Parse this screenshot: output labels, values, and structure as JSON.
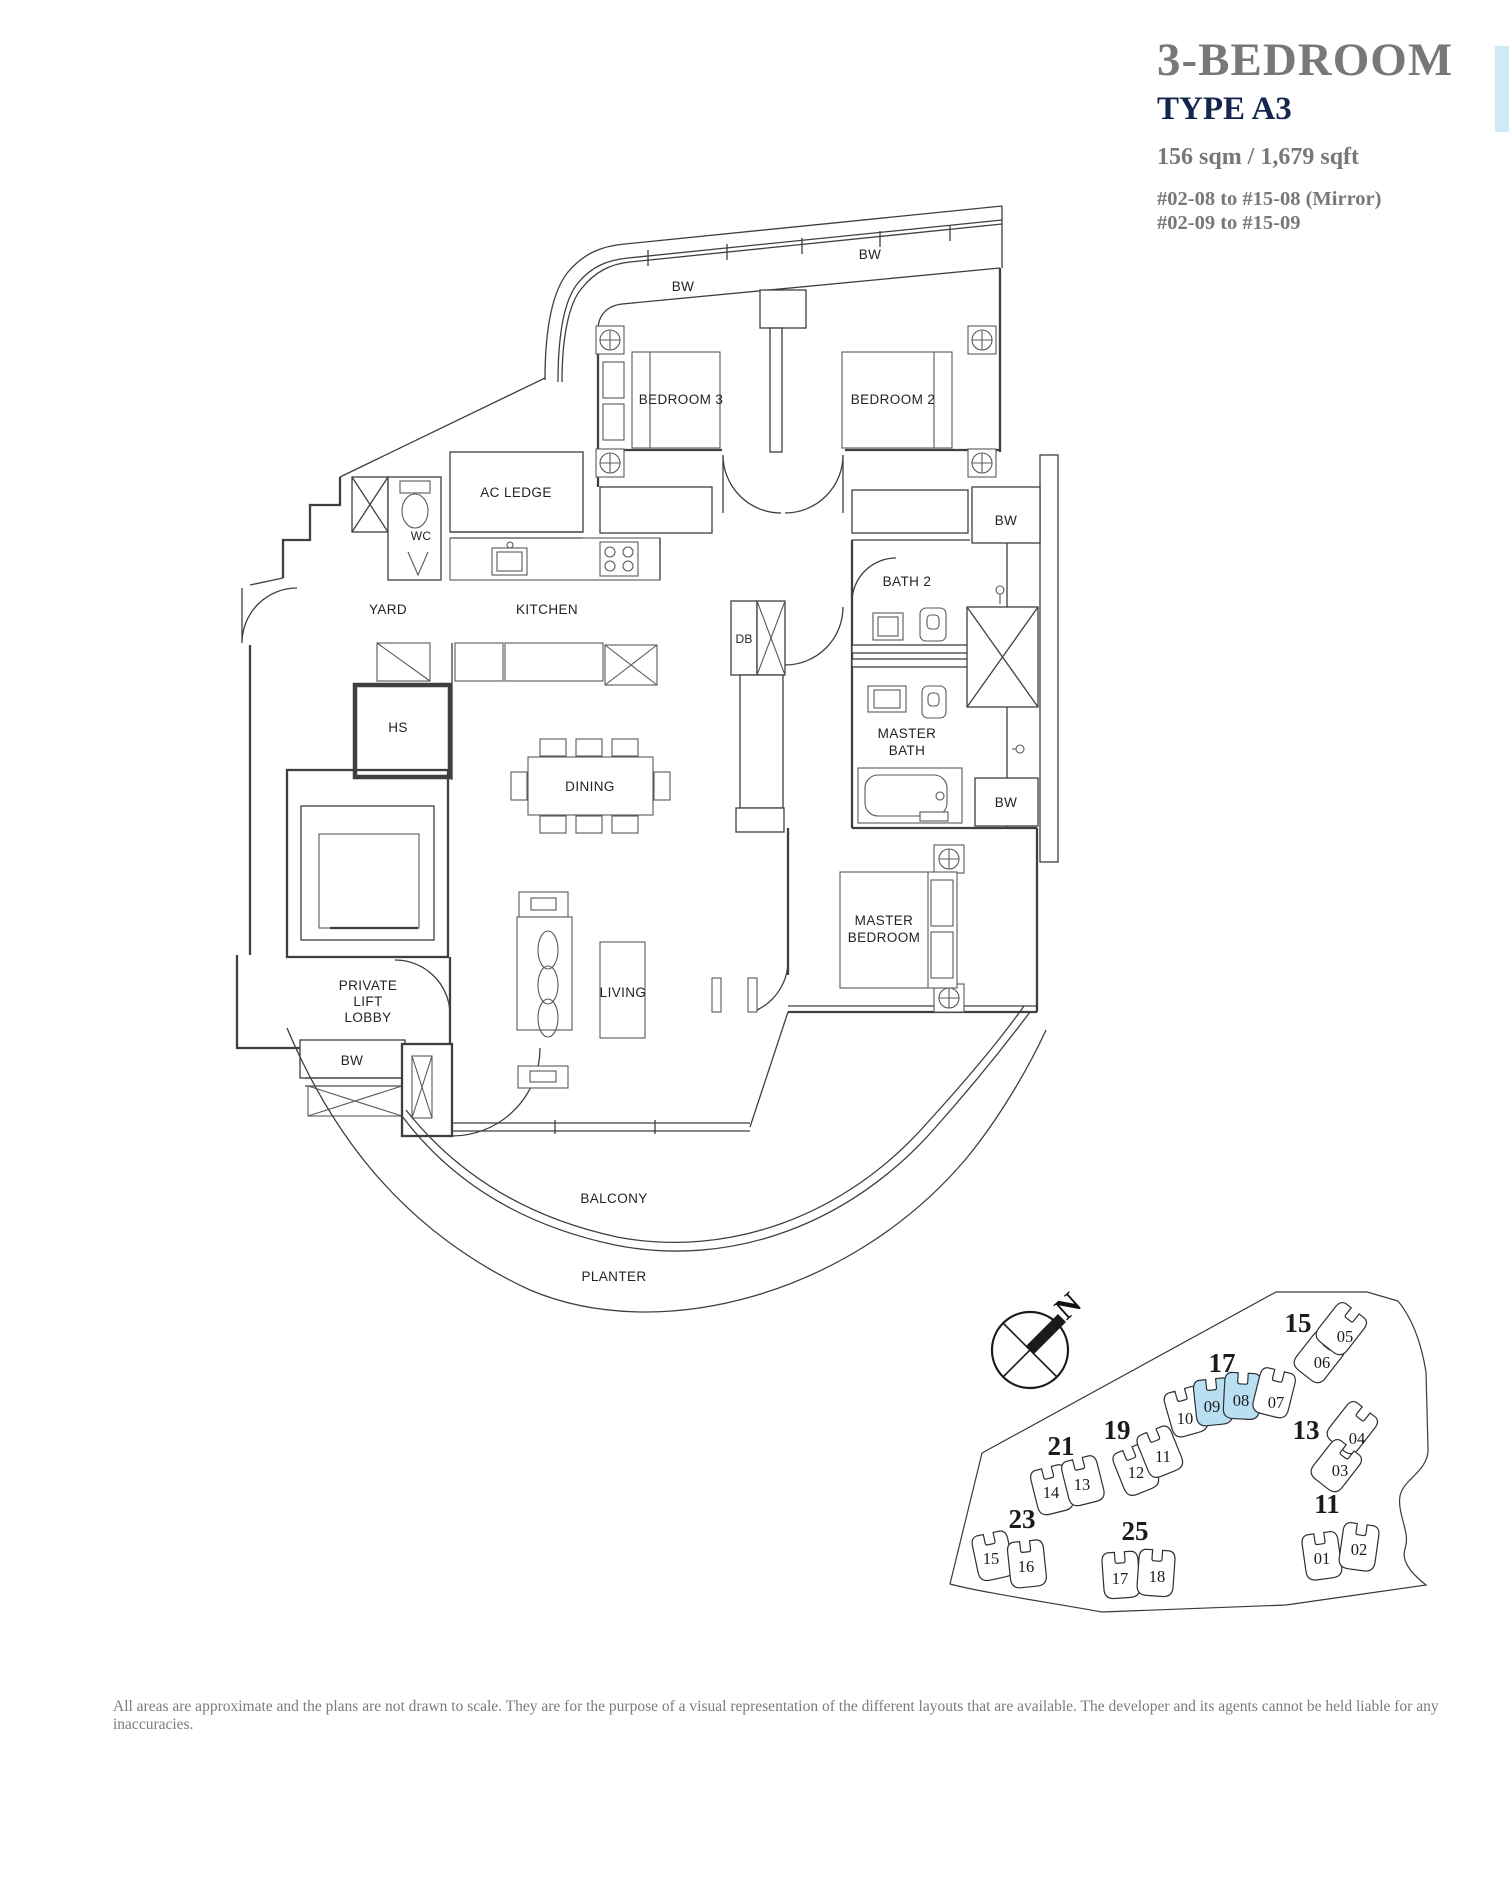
{
  "title": {
    "heading": "3-BEDROOM",
    "type": "TYPE A3",
    "area": "156 sqm / 1,679 sqft",
    "units_mirror": "#02-08 to #15-08 (Mirror)",
    "units": "#02-09 to #15-09"
  },
  "colors": {
    "accent_navy": "#15264e",
    "text_gray": "#77787b",
    "side_tab_blue": "#cfe9f5",
    "line_dark": "#3f3f3f"
  },
  "floor_plan": {
    "labels": {
      "bw": "BW",
      "bedroom3": "BEDROOM 3",
      "bedroom2": "BEDROOM 2",
      "ac_ledge": "AC LEDGE",
      "wc": "WC",
      "yard": "YARD",
      "kitchen": "KITCHEN",
      "bath2": "BATH 2",
      "db": "DB",
      "hs": "HS",
      "dining": "DINING",
      "living": "LIVING",
      "balcony": "BALCONY",
      "planter": "PLANTER",
      "master_bath": [
        "MASTER",
        "BATH"
      ],
      "master_bedroom": [
        "MASTER",
        "BEDROOM"
      ],
      "private_lift_lobby": [
        "PRIVATE",
        "LIFT",
        "LOBBY"
      ]
    }
  },
  "compass": {
    "north": "N"
  },
  "site_plan": {
    "highlight_color": "#b9e0f2",
    "blocks": [
      {
        "number": "17",
        "units": [
          {
            "no": "10",
            "highlighted": false
          },
          {
            "no": "09",
            "highlighted": true
          },
          {
            "no": "08",
            "highlighted": true
          },
          {
            "no": "07",
            "highlighted": false
          }
        ]
      },
      {
        "number": "15",
        "units": [
          {
            "no": "06",
            "highlighted": false
          },
          {
            "no": "05",
            "highlighted": false
          }
        ]
      },
      {
        "number": "13",
        "units": [
          {
            "no": "04",
            "highlighted": false
          },
          {
            "no": "03",
            "highlighted": false
          }
        ]
      },
      {
        "number": "19",
        "units": [
          {
            "no": "12",
            "highlighted": false
          },
          {
            "no": "11",
            "highlighted": false
          }
        ]
      },
      {
        "number": "21",
        "units": [
          {
            "no": "14",
            "highlighted": false
          },
          {
            "no": "13",
            "highlighted": false
          }
        ]
      },
      {
        "number": "23",
        "units": [
          {
            "no": "15",
            "highlighted": false
          },
          {
            "no": "16",
            "highlighted": false
          }
        ]
      },
      {
        "number": "25",
        "units": [
          {
            "no": "17",
            "highlighted": false
          },
          {
            "no": "18",
            "highlighted": false
          }
        ]
      },
      {
        "number": "11",
        "units": [
          {
            "no": "01",
            "highlighted": false
          },
          {
            "no": "02",
            "highlighted": false
          }
        ]
      }
    ]
  },
  "disclaimer": "All areas are approximate and the plans are not drawn to scale. They are for the purpose of a visual representation of the different layouts that are available. The developer and its agents cannot be held liable for any inaccuracies."
}
